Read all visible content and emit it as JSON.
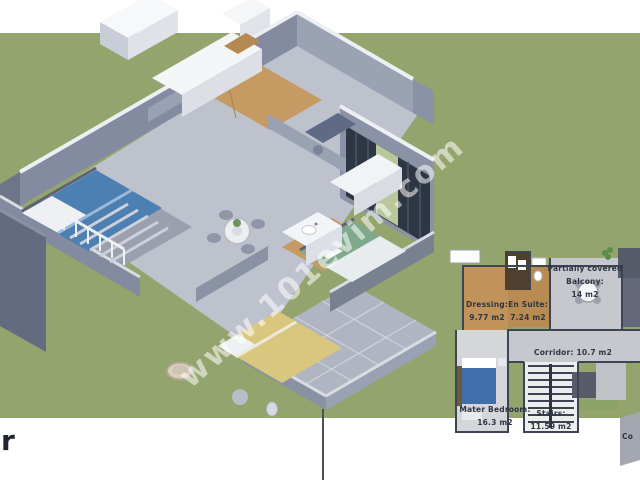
{
  "watermark": "www.101evim.com",
  "corner_letter": "r",
  "plan2d": {
    "balcony": {
      "l1": "Partially covered",
      "l2": "Balcony:",
      "l3": "14 m2"
    },
    "dressing": {
      "l1": "Dressing:",
      "l2": "9.77 m2"
    },
    "ensuite": {
      "l1": "En Suite:",
      "l2": "7.24 m2"
    },
    "corridor": {
      "l1": "Corridor: 10.7 m2"
    },
    "master": {
      "l1": "Mater Bedroom:",
      "l2": "16.3 m2"
    },
    "stairs": {
      "l1": "Stairs:",
      "l2": "11.59 m2"
    },
    "clipped": {
      "l1": "Co"
    }
  },
  "colors": {
    "panel_green": "#94a46d",
    "wall_dark": "#7b8296",
    "wall_light": "#9ba2b4",
    "wood_floor": "#c59b63",
    "bed_blue": "#4c7fb2",
    "bed_green": "#7fa98d",
    "bed_yellow": "#d9c77d",
    "curtain_dark": "#2e3543",
    "label_text": "#2f3542"
  }
}
